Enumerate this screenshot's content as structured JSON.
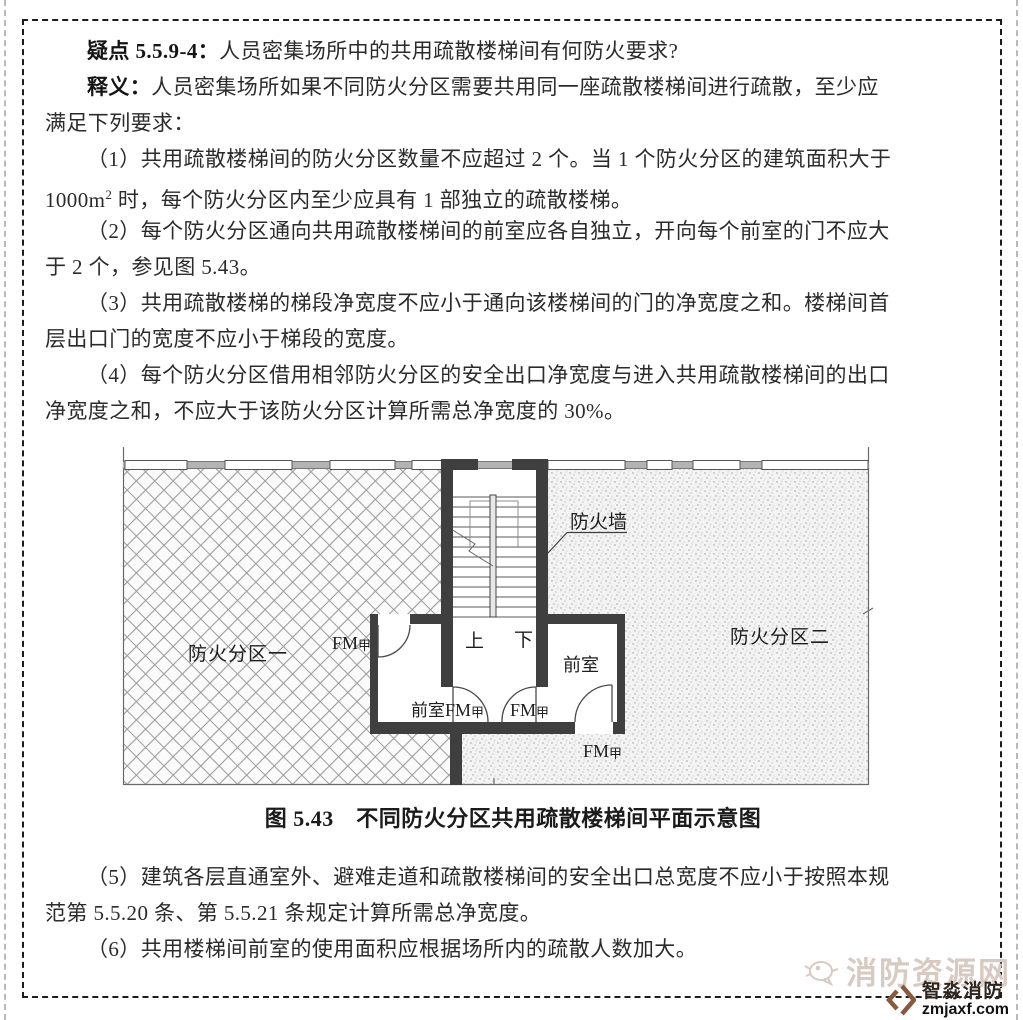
{
  "paragraphs": {
    "p1": {
      "lead": "疑点 5.5.9-4：",
      "text": "人员密集场所中的共用疏散楼梯间有何防火要求?"
    },
    "p2": {
      "lead": "释义：",
      "line1": "人员密集场所如果不同防火分区需要共用同一座疏散楼梯间进行疏散，至少应",
      "line2": "满足下列要求："
    },
    "p3": {
      "line1": "（1）共用疏散楼梯间的防火分区数量不应超过 2 个。当 1 个防火分区的建筑面积大于",
      "line2a": "1000m",
      "line2sup": "2",
      "line2b": " 时，每个防火分区内至少应具有 1 部独立的疏散楼梯。"
    },
    "p4": {
      "line1": "（2）每个防火分区通向共用疏散楼梯间的前室应各自独立，开向每个前室的门不应大",
      "line2": "于 2 个，参见图 5.43。"
    },
    "p5": {
      "line1": "（3）共用疏散楼梯的梯段净宽度不应小于通向该楼梯间的门的净宽度之和。楼梯间首",
      "line2": "层出口门的宽度不应小于梯段的宽度。"
    },
    "p6": {
      "line1": "（4）每个防火分区借用相邻防火分区的安全出口净宽度与进入共用疏散楼梯间的出口",
      "line2": "净宽度之和，不应大于该防火分区计算所需总净宽度的 30%。"
    },
    "p7": {
      "line1": "（5）建筑各层直通室外、避难走道和疏散楼梯间的安全出口总宽度不应小于按照本规",
      "line2": "范第 5.5.20 条、第 5.5.21 条规定计算所需总净宽度。"
    },
    "p8": {
      "line1": "（6）共用楼梯间前室的使用面积应根据场所内的疏散人数加大。"
    }
  },
  "figure": {
    "caption": "图 5.43　不同防火分区共用疏散楼梯间平面示意图",
    "labels": {
      "fire_wall": "防火墙",
      "zone1": "防火分区一",
      "zone2": "防火分区二",
      "anteroom": "前室",
      "up": "上",
      "down": "下",
      "door_fm": "FM",
      "door_class": "甲"
    }
  },
  "watermark": {
    "site": "消防资源网",
    "brand": "智淼消防",
    "domain": "zmjaxf.com"
  },
  "colors": {
    "wall": "#3f3f3f",
    "text": "#2b2b2b",
    "watermark_light": "#d8cac2",
    "brand_brown": "#8a5a3f"
  }
}
